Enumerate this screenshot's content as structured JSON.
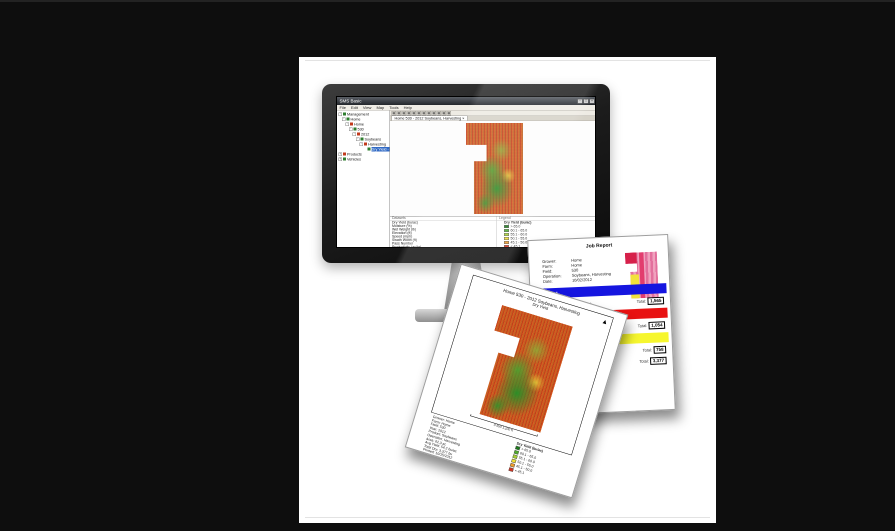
{
  "colors": {
    "background": "#0e0e0e",
    "canvas": "#ffffff",
    "bezel": "#1c1c1c",
    "titlebar": "#2b2f35",
    "selection": "#316ac5",
    "bar_blue": "#1515e0",
    "bar_red": "#e81212",
    "bar_yellow": "#f6f62e",
    "map_red": "#cf4a1e",
    "map_green": "#2e9128",
    "mini_pink": "#f0a2be",
    "mini_crimson": "#d6204a",
    "mini_yellow": "#f2e23c"
  },
  "window": {
    "title": "SMS Basic",
    "window_buttons": [
      "‒",
      "□",
      "×"
    ],
    "menu": [
      "File",
      "Edit",
      "View",
      "Map",
      "Tools",
      "Help"
    ],
    "toolbar_icons": [
      "open-icon",
      "save-icon",
      "print-icon",
      "undo-icon",
      "zoom-in-icon",
      "zoom-out-icon",
      "pan-icon",
      "select-icon",
      "measure-icon",
      "layers-icon",
      "chart-icon",
      "info-icon"
    ],
    "tab": "Home 530 - 2012 Soybeans, Harvesting  ×",
    "tree": [
      {
        "level": 0,
        "label": "Management",
        "bullet": "#2e7d2e",
        "exp": "-"
      },
      {
        "level": 1,
        "label": "Home",
        "bullet": "#2e7d2e",
        "exp": "-"
      },
      {
        "level": 2,
        "label": "Home",
        "bullet": "#c23a1c",
        "exp": "-"
      },
      {
        "level": 3,
        "label": "530",
        "bullet": "#2e7d2e",
        "exp": "-"
      },
      {
        "level": 4,
        "label": "2012",
        "bullet": "#c23a1c",
        "exp": "-"
      },
      {
        "level": 5,
        "label": "Soybeans",
        "bullet": "#2e7d2e",
        "exp": "-"
      },
      {
        "level": 6,
        "label": "Harvesting",
        "bullet": "#c23a1c",
        "exp": "-"
      },
      {
        "level": 7,
        "label": "Dry Yield - 10/02/2012",
        "bullet": "#2e7d2e",
        "exp": "",
        "selected": true
      },
      {
        "level": 0,
        "label": "Products",
        "bullet": "#c23a1c",
        "exp": "+"
      },
      {
        "level": 0,
        "label": "Vehicles",
        "bullet": "#2e7d2e",
        "exp": "+"
      }
    ],
    "bottom": {
      "col1_header": "Datasets",
      "col2_header": "Legend",
      "rows": [
        "Dry Yield (bu/ac)",
        "Moisture (%)",
        "Wet Weight (lb)",
        "Elevation (ft)",
        "Speed (mph)",
        "Swath Width (ft)",
        "Pass Number",
        "Productivity (ac/hr)"
      ],
      "legend_title": "Dry Yield (bu/ac)"
    }
  },
  "legend": {
    "classes": [
      {
        "label": "> 65.0",
        "color": "#1c7a1c"
      },
      {
        "label": "60.1 - 65.0",
        "color": "#4fae2c"
      },
      {
        "label": "55.1 - 60.0",
        "color": "#a8d232"
      },
      {
        "label": "50.1 - 55.0",
        "color": "#f0df30"
      },
      {
        "label": "45.1 - 50.0",
        "color": "#ef9b28"
      },
      {
        "label": "< 45.1",
        "color": "#d8301c"
      }
    ]
  },
  "map_page": {
    "title": "Home 530 - 2012 Soybeans, Harvesting",
    "subtitle": "Dry Yield",
    "north_glyph": "▲",
    "scale_label": "0        550        1,100 ft",
    "info_lines": [
      "Grower: Home",
      "Farm: Home",
      "Field: 530",
      "Year: 2012",
      "Product: Soybeans",
      "Operation: Harvesting",
      "Area: 62.3 ac",
      "Avg Yield: 54.2 bu/ac",
      "Total Dry: 3,377 bu",
      "Printed: 10/15/2012"
    ],
    "legend_title": "Dry Yield (bu/ac)"
  },
  "report_page": {
    "title": "Job Report",
    "info": [
      {
        "label": "Grower:",
        "value": "Home"
      },
      {
        "label": "Farm:",
        "value": "Home"
      },
      {
        "label": "Field:",
        "value": "530"
      },
      {
        "label": "Operation:",
        "value": "Soybeans, Harvesting"
      },
      {
        "label": "Date:",
        "value": "10/02/2012"
      }
    ],
    "sections": [
      {
        "name": "Product 1",
        "bar_color": "#1515e0",
        "text_color": "#ffffff",
        "stats": "Area: 28.4 ac      Avg: 55.1 bu/ac",
        "total_label": "Total:",
        "total": "1,565"
      },
      {
        "name": "Product 2",
        "bar_color": "#e81212",
        "text_color": "#3d0000",
        "stats": "Area: 19.6 ac      Avg: 53.8 bu/ac",
        "total_label": "Total:",
        "total": "1,054"
      },
      {
        "name": "Product 3",
        "bar_color": "#f6f62e",
        "text_color": "#3d3d00",
        "stats": "Area: 14.3 ac      Avg: 52.9 bu/ac",
        "total_label": "Total:",
        "total": "758"
      }
    ],
    "summary": {
      "stats": "Totals:   Area: 62.3 ac      Avg: 54.2 bu/ac",
      "total_label": "Total:",
      "total": "3,377"
    }
  }
}
